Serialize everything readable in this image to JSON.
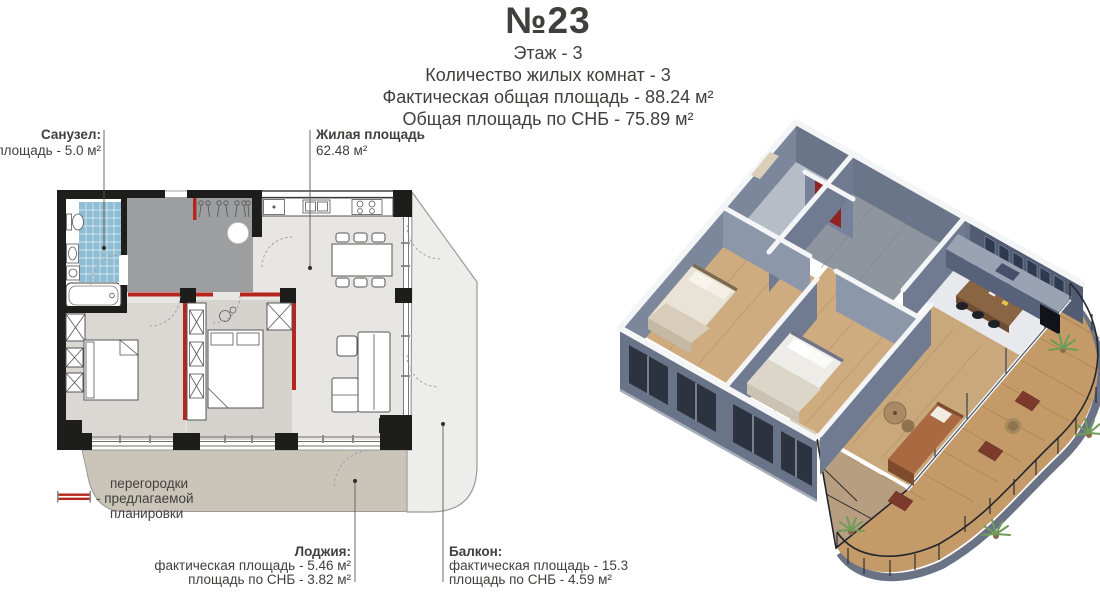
{
  "header": {
    "unit_number": "№23",
    "floor_line": "Этаж - 3",
    "rooms_line": "Количество жилых комнат - 3",
    "actual_area_line": "Фактическая общая площадь - 88.24 м²",
    "snb_area_line": "Общая площадь по СНБ - 75.89 м²"
  },
  "floor_plan": {
    "bathroom_label": {
      "title": "Санузел:",
      "area": "площадь - 5.0 м²"
    },
    "living_area_label": {
      "title": "Жилая площадь",
      "area": "62.48 м²"
    },
    "loggia_label": {
      "title": "Лоджия:",
      "actual": "фактическая площадь - 5.46 м²",
      "snb": "площадь по СНБ - 3.82 м²"
    },
    "balcony_label": {
      "title": "Балкон:",
      "actual": "фактическая площадь - 15.3 м²",
      "snb": "площадь по СНБ - 4.59 м²"
    },
    "legend": {
      "line1": "перегородки",
      "line2": "- предлагаемой",
      "line3": "планировки"
    }
  },
  "colors": {
    "partition_red": "#b5271e",
    "wall_black": "#1d1d1b",
    "tile_blue": "#8fbdd3",
    "hall_gray": "#9c9ea0",
    "loggia_beige": "#cbc5b9",
    "balcony_light": "#ededeb",
    "door_red_3d": "#8e2522",
    "deck_wood": "#c49a68"
  }
}
